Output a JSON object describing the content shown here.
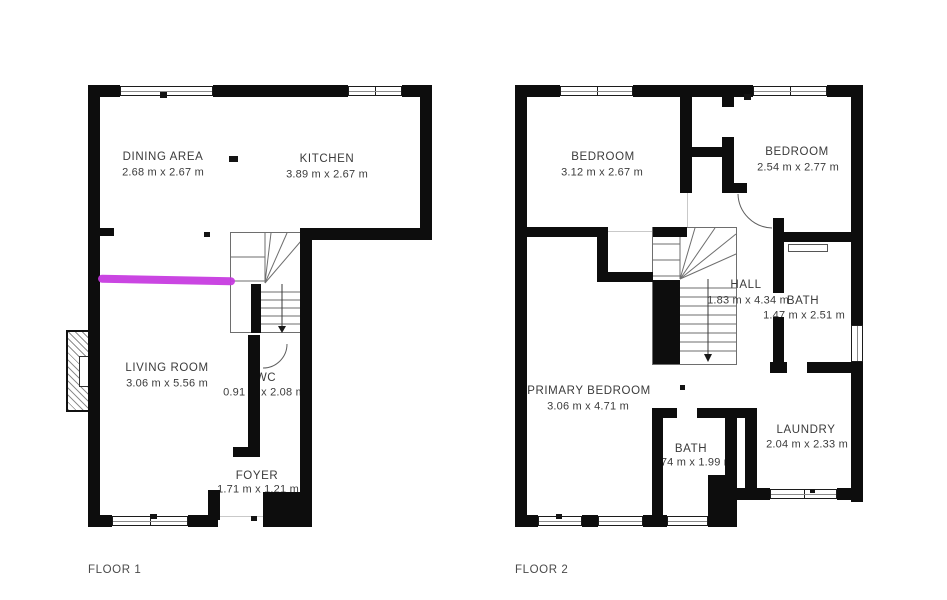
{
  "document": {
    "type": "floor-plan",
    "background": "#ffffff"
  },
  "annotation": {
    "type": "marker-line",
    "color": "#c636e0"
  },
  "floor1": {
    "label": "FLOOR 1",
    "rooms": [
      {
        "name": "DINING AREA",
        "dims": "2.68 m x 2.67 m"
      },
      {
        "name": "KITCHEN",
        "dims": "3.89 m x 2.67 m"
      },
      {
        "name": "LIVING ROOM",
        "dims": "3.06 m x 5.56 m"
      },
      {
        "name": "WC",
        "dims": "0.91 m x 2.08 m"
      },
      {
        "name": "FOYER",
        "dims": "1.71 m x 1.21 m"
      }
    ]
  },
  "floor2": {
    "label": "FLOOR 2",
    "rooms": [
      {
        "name": "BEDROOM",
        "dims": "3.12 m x 2.67 m"
      },
      {
        "name": "BEDROOM",
        "dims": "2.54 m x 2.77 m"
      },
      {
        "name": "HALL",
        "dims": "1.83 m x 4.34 m"
      },
      {
        "name": "BATH",
        "dims": "1.47 m x 2.51 m"
      },
      {
        "name": "PRIMARY BEDROOM",
        "dims": "3.06 m x 4.71 m"
      },
      {
        "name": "BATH",
        "dims": "74 m x 1.99 m"
      },
      {
        "name": "LAUNDRY",
        "dims": "2.04 m x 2.33 m"
      }
    ]
  }
}
